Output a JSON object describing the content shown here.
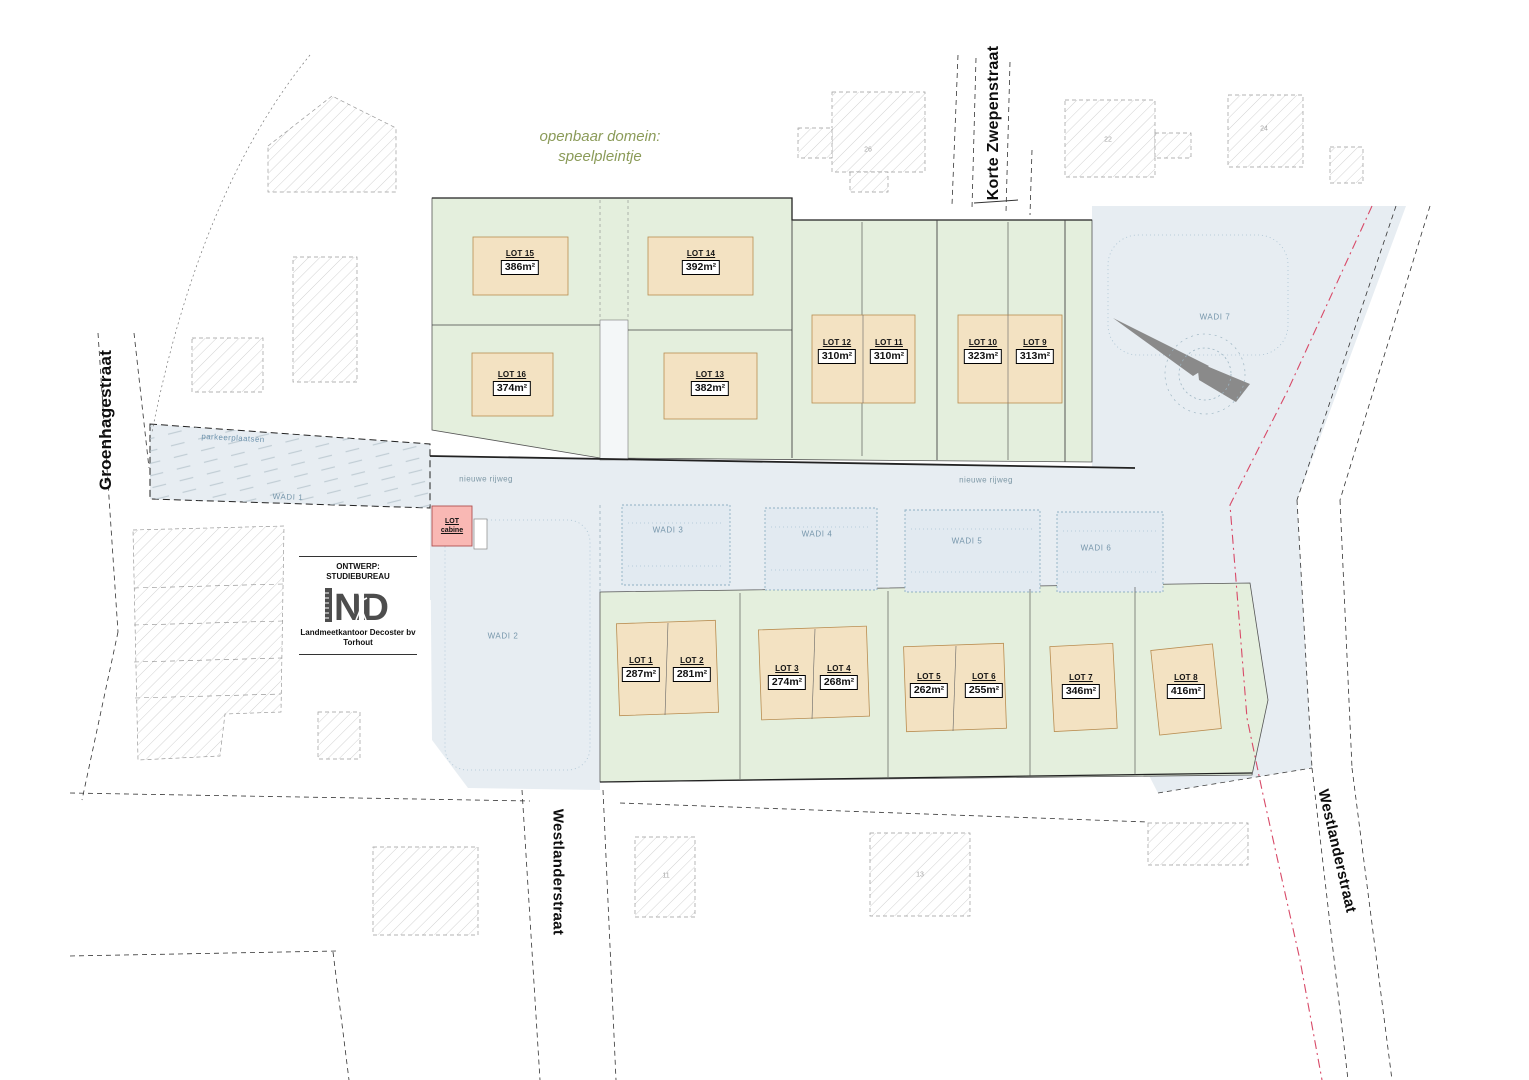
{
  "plan": {
    "title_line1": "openbaar domein:",
    "title_line2": "speelpleintje"
  },
  "streets": {
    "left": "Groenhagestraat",
    "top_right": "Korte Zwepenstraat",
    "bottom": "Westlanderstraat",
    "right": "Westlanderstraat"
  },
  "roads": {
    "new_road_left": "nieuwe rijweg",
    "new_road_right": "nieuwe rijweg",
    "parking": "parkeerplaatsen"
  },
  "wadis": [
    {
      "label": "WADI 1"
    },
    {
      "label": "WADI 2"
    },
    {
      "label": "WADI 3"
    },
    {
      "label": "WADI 4"
    },
    {
      "label": "WADI 5"
    },
    {
      "label": "WADI 6"
    },
    {
      "label": "WADI 7"
    }
  ],
  "lots": [
    {
      "label": "LOT 1",
      "area": "287m²"
    },
    {
      "label": "LOT 2",
      "area": "281m²"
    },
    {
      "label": "LOT 3",
      "area": "274m²"
    },
    {
      "label": "LOT 4",
      "area": "268m²"
    },
    {
      "label": "LOT 5",
      "area": "262m²"
    },
    {
      "label": "LOT 6",
      "area": "255m²"
    },
    {
      "label": "LOT 7",
      "area": "346m²"
    },
    {
      "label": "LOT 8",
      "area": "416m²"
    },
    {
      "label": "LOT 9",
      "area": "313m²"
    },
    {
      "label": "LOT 10",
      "area": "323m²"
    },
    {
      "label": "LOT 11",
      "area": "310m²"
    },
    {
      "label": "LOT 12",
      "area": "310m²"
    },
    {
      "label": "LOT 13",
      "area": "382m²"
    },
    {
      "label": "LOT 14",
      "area": "392m²"
    },
    {
      "label": "LOT 15",
      "area": "386m²"
    },
    {
      "label": "LOT 16",
      "area": "374m²"
    }
  ],
  "cabine": {
    "line1": "LOT",
    "line2": "cabine"
  },
  "legend_logo": {
    "line1": "ONTWERP:",
    "line2": "STUDIEBUREAU",
    "monogram": "ND",
    "firm": "Landmeetkantoor Decoster bv",
    "city": "Torhout"
  },
  "house_numbers": {
    "h22": "22",
    "h24": "24",
    "h26": "26",
    "h13": "13",
    "h11": "11"
  },
  "colors": {
    "lot_green": "#e4efdd",
    "building_tan": "#f3e2c2",
    "water_blue": "#e7edf2",
    "cabine_pink": "#f9b8b4",
    "boundary_red": "#d84a68"
  }
}
